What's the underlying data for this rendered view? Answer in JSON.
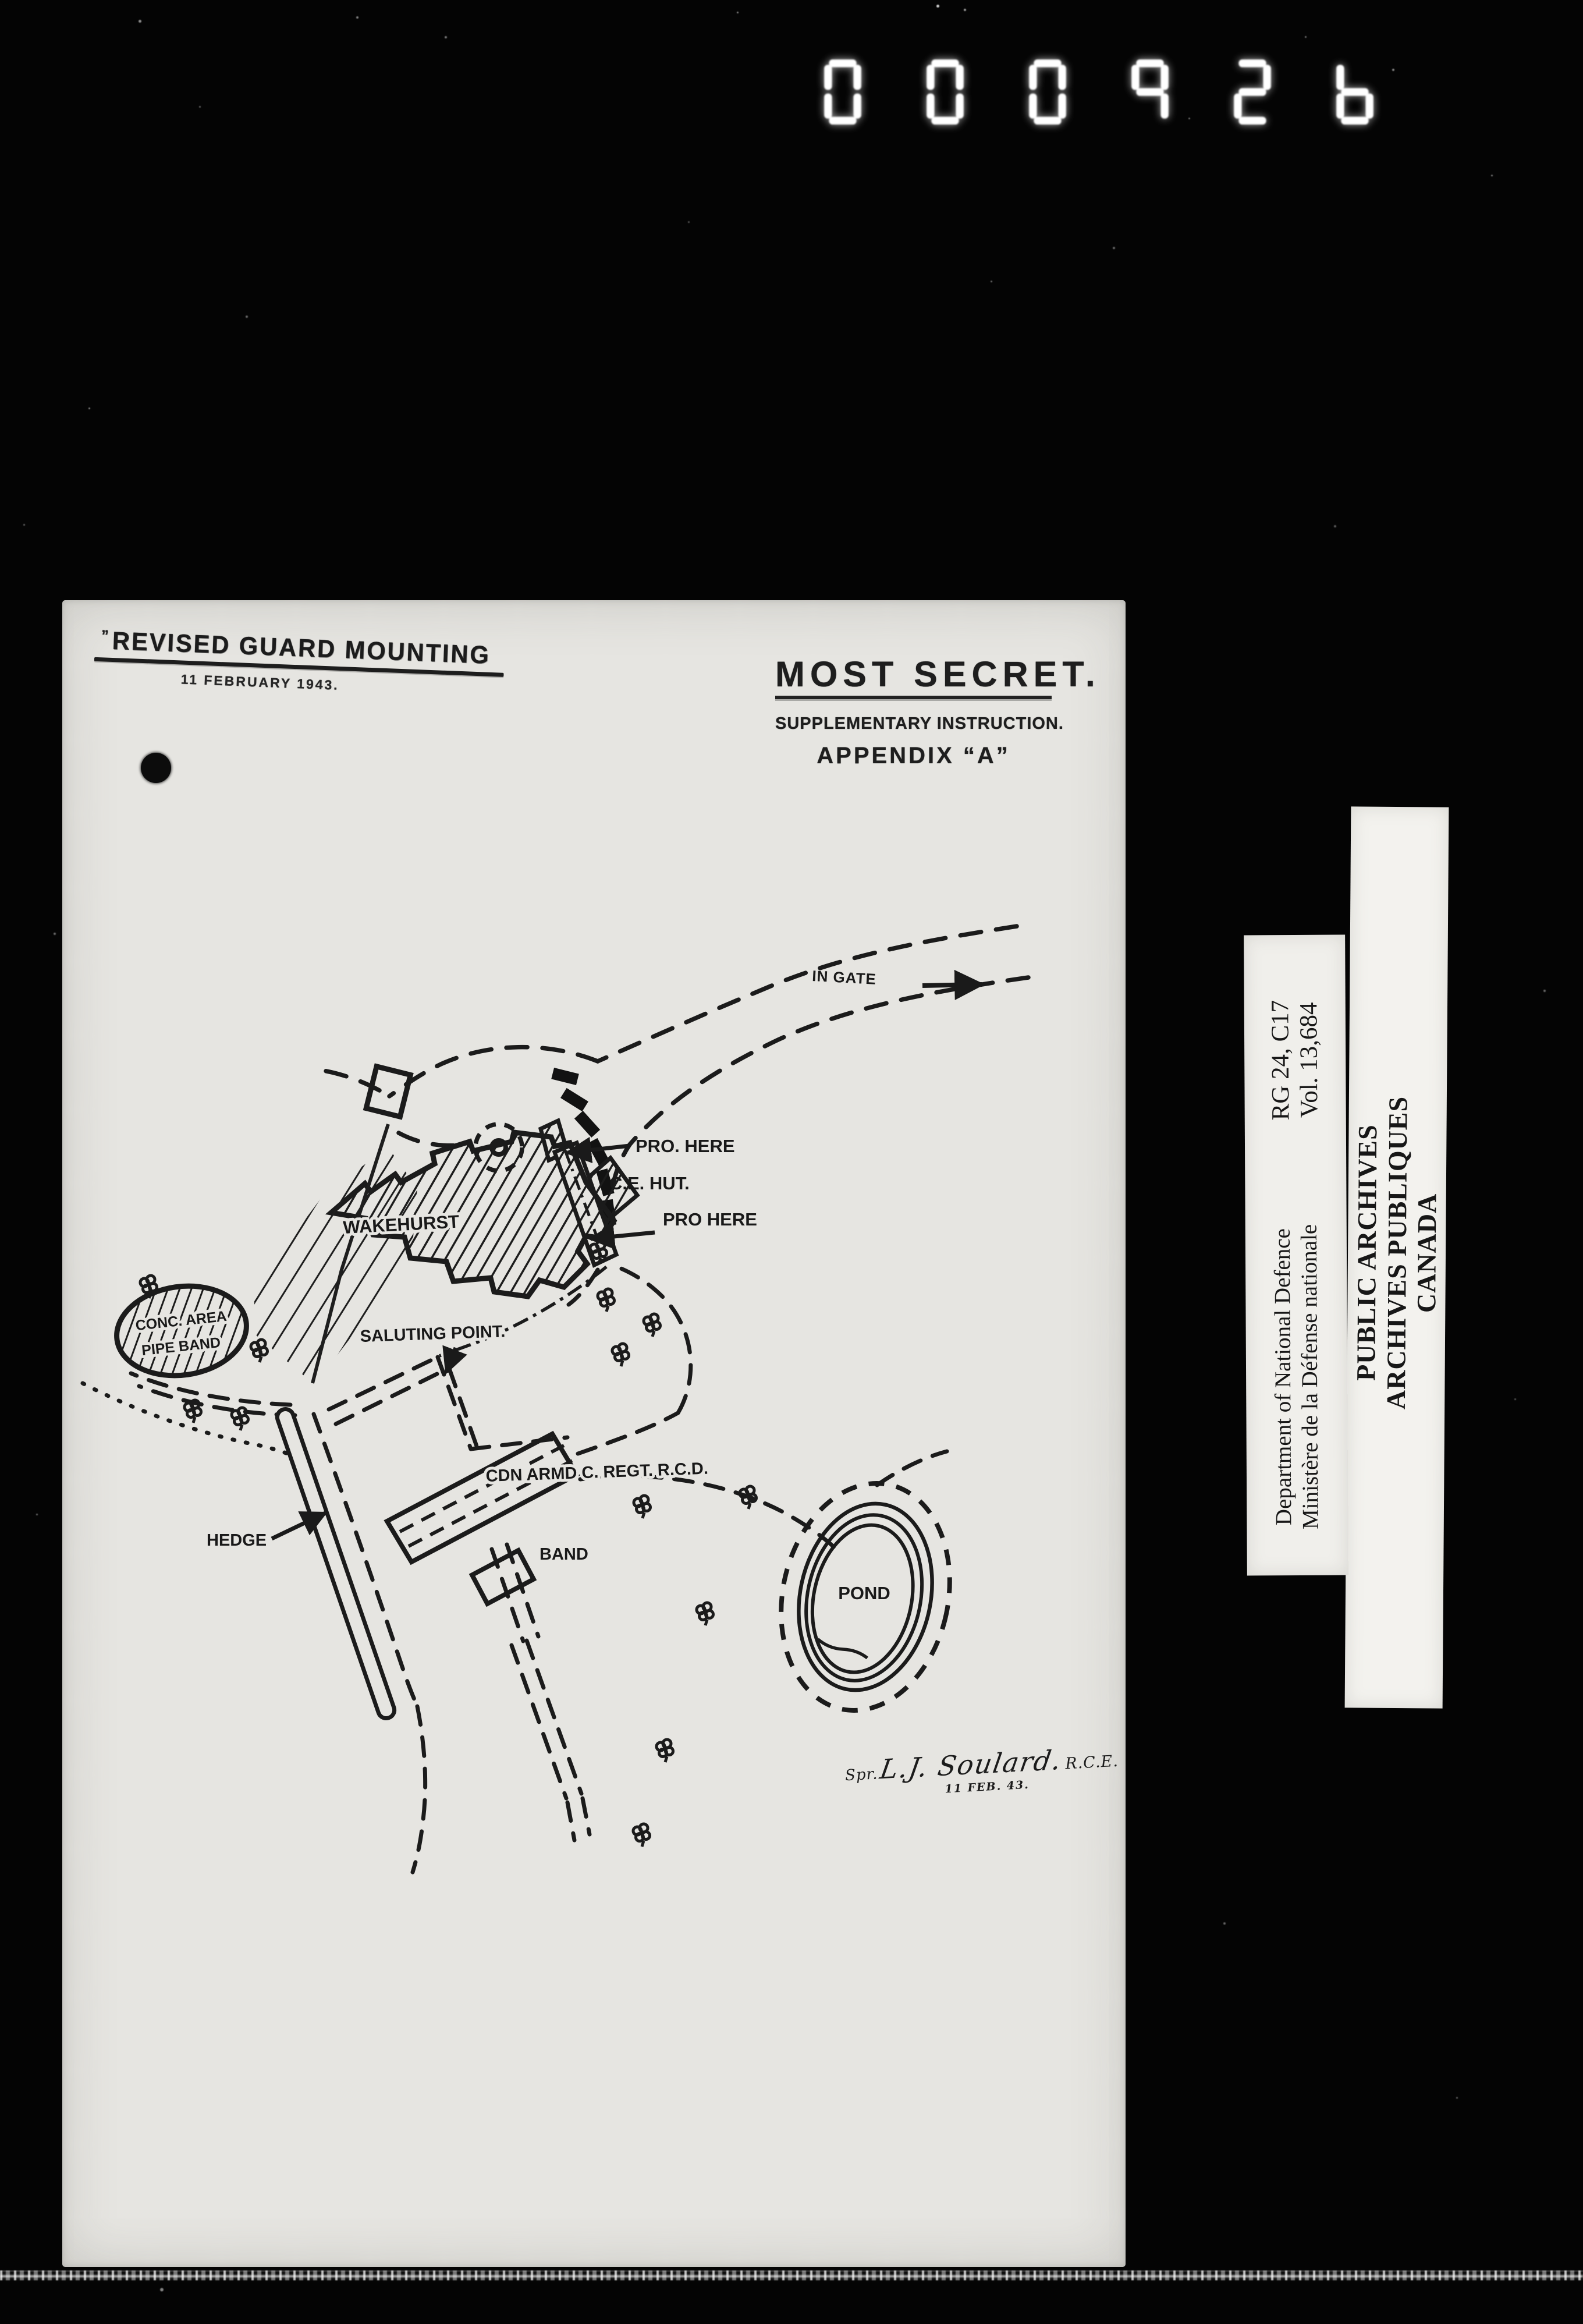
{
  "film": {
    "counter_digits": "000926"
  },
  "stamp": {
    "prefix_mark": "”",
    "title": "REVISED GUARD MOUNTING",
    "date": "11 FEBRUARY 1943."
  },
  "header": {
    "classification": "MOST SECRET.",
    "subtitle": "SUPPLEMENTARY INSTRUCTION.",
    "appendix": "APPENDIX “A”"
  },
  "map": {
    "labels": {
      "in_gate": "IN GATE",
      "pro_here_top": "PRO. HERE",
      "ce_hut": "C.E. HUT.",
      "pro_here_bottom": "PRO HERE",
      "wakehurst": "WAKEHURST",
      "conc_area_line1": "CONC. AREA",
      "conc_area_line2": "PIPE BAND",
      "saluting_point": "SALUTING POINT.",
      "cdn_armd_regt": "CDN ARMD C. REGT. R.C.D.",
      "band": "BAND",
      "hedge": "HEDGE",
      "pond": "POND"
    },
    "signature": {
      "prefix": "Spr.",
      "name": "L.J. Soulard.",
      "suffix": "R.C.E.",
      "date": "11 FEB. 43."
    }
  },
  "archive_labels": {
    "reference": {
      "line1": "RG 24, C17",
      "line2": "Vol. 13,684"
    },
    "department": {
      "line1": "Department of National Defence",
      "line2": "Ministère de la Défense nationale"
    },
    "archives": {
      "line1": "PUBLIC ARCHIVES",
      "line2": "ARCHIVES PUBLIQUES",
      "line3": "CANADA"
    }
  }
}
